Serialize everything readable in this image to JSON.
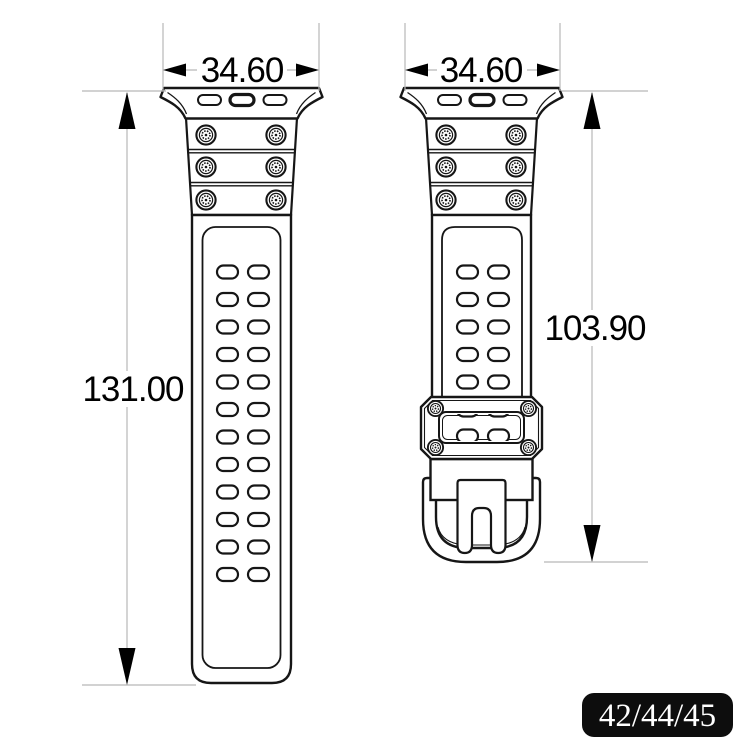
{
  "drawing": {
    "title": "watch strap technical drawing",
    "left_view": {
      "width_label": "34.60",
      "length_label": "131.00",
      "hole_rows": 12,
      "holes_per_row": 2,
      "screw_count": 6,
      "lug_slot_count": 3
    },
    "right_view": {
      "width_label": "34.60",
      "length_label": "103.90",
      "hole_rows": 5,
      "holes_per_row": 2,
      "screw_count": 6,
      "lug_slot_count": 3,
      "keeper_screw_count": 4
    },
    "size_badge": {
      "label": "42/44/45"
    },
    "colors": {
      "outline": "#161616",
      "dimension_line": "#b8b8b8",
      "dimension_text": "#000000",
      "badge_background": "#0d0d0d",
      "badge_text": "#ffffff",
      "background": "#ffffff"
    }
  }
}
